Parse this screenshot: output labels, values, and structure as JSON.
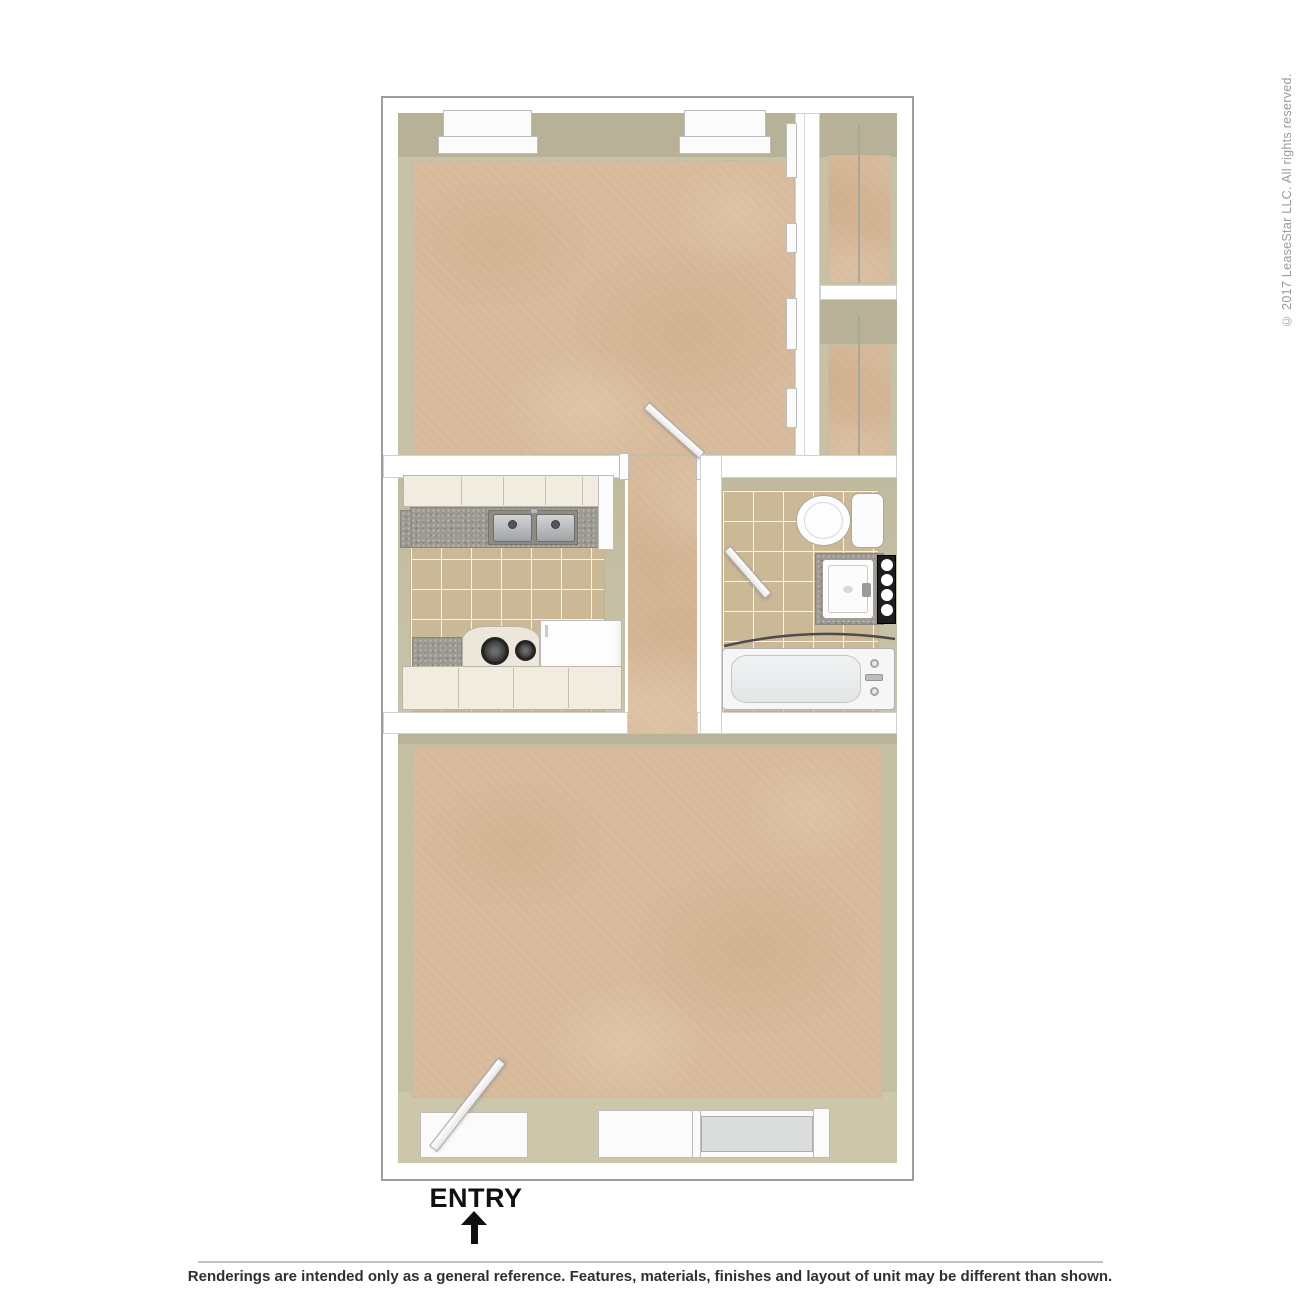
{
  "page": {
    "copyright_vertical": "© 2017 LeaseStar LLC. All rights reserved.",
    "footer_disclaimer": "Renderings are intended only as a general reference. Features, materials, finishes and layout of unit may be different than shown.",
    "entry": {
      "label": "ENTRY",
      "arrow_direction": "up"
    }
  },
  "floor_plan": {
    "type": "apartment-unit-3d-top-down-rendering",
    "rooms": [
      "bedroom",
      "closet-top",
      "closet-bottom",
      "kitchen",
      "hallway",
      "bathroom",
      "living-room"
    ],
    "fixtures": {
      "bedroom": [
        "window",
        "window",
        "sliding-closet-doors",
        "swing-door"
      ],
      "kitchen": [
        "upper-cabinets",
        "countertop",
        "double-basin-sink",
        "range-stove",
        "refrigerator",
        "base-cabinets"
      ],
      "bathroom": [
        "toilet",
        "vanity-counter",
        "vanity-sink",
        "vanity-light-bar",
        "shower-curtain-rod",
        "bathtub",
        "swing-door"
      ],
      "living_room": [
        "entry-swing-door",
        "window-opening",
        "sliding-patio-door"
      ]
    },
    "palette": {
      "wall_white": "#ffffff",
      "wall_outline": "#9d9d9d",
      "wall_face_olive": "#c0bb9f",
      "carpet_tan": "#d9bc9d",
      "tile_tan": "#cab896",
      "counter_gray": "#9d9992",
      "cabinet_cream": "#f1ece0",
      "fixture_white": "#fbfbfb",
      "burner_black": "#333333",
      "text_dark": "#303030",
      "text_gray": "#9a9a9a"
    }
  }
}
